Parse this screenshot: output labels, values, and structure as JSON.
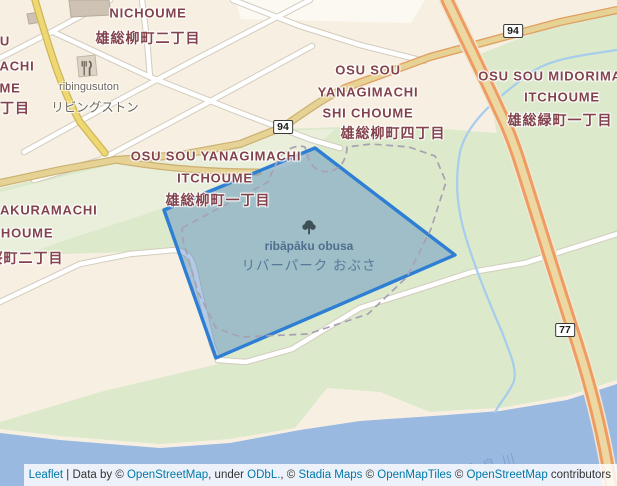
{
  "map": {
    "type": "leaflet-map",
    "colors": {
      "land": "#f7f0e2",
      "green": "#dce9ca",
      "green_pale": "#e9efdb",
      "river": "#9ab9e1",
      "stream": "#a6cdec",
      "road_white": "#ffffff",
      "road_casing": "#d2ccbd",
      "road_yellow": "#eed873",
      "road_tan": "#e7d295",
      "highway_orange": "#ef9c62",
      "highway_center": "#ecd8a2",
      "park_overlay_fill": "rgba(84,138,198,0.45)",
      "park_overlay_border": "#2e7fd4",
      "label_place": "#83434c",
      "label_poi": "#6c675e",
      "label_park": "#4e6e8e",
      "park_boundary_dash": "#a8a1b3",
      "building": "#cdc2b4"
    },
    "labels": [
      {
        "name": "label-nichoume-en",
        "text": "NICHOUME",
        "x": 148,
        "y": 13,
        "cls": "place"
      },
      {
        "name": "label-nichoume-ja",
        "text": "雄総柳町二丁目",
        "x": 148,
        "y": 38,
        "cls": "place-ja"
      },
      {
        "name": "label-edge-fragment-1",
        "text": "U",
        "x": 5,
        "y": 41,
        "cls": "place"
      },
      {
        "name": "label-edge-fragment-2",
        "text": "ACHI",
        "x": 17,
        "y": 66,
        "cls": "place"
      },
      {
        "name": "label-edge-fragment-3",
        "text": "ME",
        "x": 10,
        "y": 88,
        "cls": "place"
      },
      {
        "name": "label-edge-fragment-4",
        "text": "丁目",
        "x": 15,
        "y": 108,
        "cls": "place-ja"
      },
      {
        "name": "label-ribingusuton-en",
        "text": "ribingusuton",
        "x": 89,
        "y": 87,
        "cls": "poi"
      },
      {
        "name": "label-ribingusuton-ja",
        "text": "リビングストン",
        "x": 95,
        "y": 106,
        "cls": "poi-ja"
      },
      {
        "name": "label-yanagimachi4-line1",
        "text": "OSU SOU",
        "x": 368,
        "y": 70,
        "cls": "place"
      },
      {
        "name": "label-yanagimachi4-line2",
        "text": "YANAGIMACHI",
        "x": 368,
        "y": 92,
        "cls": "place"
      },
      {
        "name": "label-yanagimachi4-line3",
        "text": "SHI CHOUME",
        "x": 368,
        "y": 113,
        "cls": "place"
      },
      {
        "name": "label-yanagimachi4-ja",
        "text": "雄総柳町四丁目",
        "x": 393,
        "y": 133,
        "cls": "place-ja"
      },
      {
        "name": "label-midorimachi-line1",
        "text": "OSU SOU MIDORIMA",
        "x": 550,
        "y": 76,
        "cls": "place"
      },
      {
        "name": "label-midorimachi-line2",
        "text": "ITCHOUME",
        "x": 562,
        "y": 97,
        "cls": "place"
      },
      {
        "name": "label-midorimachi-ja",
        "text": "雄総緑町一丁目",
        "x": 560,
        "y": 120,
        "cls": "place-ja"
      },
      {
        "name": "label-yanagimachi1-line1",
        "text": "OSU SOU YANAGIMACHI",
        "x": 216,
        "y": 156,
        "cls": "place"
      },
      {
        "name": "label-yanagimachi1-line2",
        "text": "ITCHOUME",
        "x": 215,
        "y": 178,
        "cls": "place"
      },
      {
        "name": "label-yanagimachi1-ja",
        "text": "雄総柳町一丁目",
        "x": 218,
        "y": 200,
        "cls": "place-ja"
      },
      {
        "name": "label-sakuramachi-en",
        "text": "SAKURAMACHI",
        "x": 44,
        "y": 210,
        "cls": "place"
      },
      {
        "name": "label-sakuramachi-line2",
        "text": "CHOUME",
        "x": 22,
        "y": 233,
        "cls": "place"
      },
      {
        "name": "label-sakuramachi-ja",
        "text": "桜町二丁目",
        "x": 26,
        "y": 258,
        "cls": "place-ja"
      },
      {
        "name": "label-park-name-en",
        "text": "ribāpāku obusa",
        "x": 309,
        "y": 246,
        "cls": "park"
      },
      {
        "name": "label-park-name-ja",
        "text": "リバーパーク おぶさ",
        "x": 309,
        "y": 264,
        "cls": "park-ja"
      },
      {
        "name": "label-river-name",
        "text": "長良川",
        "x": 492,
        "y": 463,
        "cls": "river",
        "rot": -14
      }
    ],
    "shields": [
      {
        "name": "route-shield-94-west",
        "label": "94",
        "x": 283,
        "y": 127
      },
      {
        "name": "route-shield-94-east",
        "label": "94",
        "x": 513,
        "y": 31
      },
      {
        "name": "route-shield-77",
        "label": "77",
        "x": 565,
        "y": 330
      }
    ],
    "attribution": {
      "parts": [
        {
          "text": "Leaflet",
          "link": true,
          "name": "leaflet-link"
        },
        {
          "text": " | Data by © ",
          "link": false
        },
        {
          "text": "OpenStreetMap",
          "link": true,
          "name": "openstreetmap-link"
        },
        {
          "text": ", under ",
          "link": false
        },
        {
          "text": "ODbL.",
          "link": true,
          "name": "odbl-link"
        },
        {
          "text": ", © ",
          "link": false
        },
        {
          "text": "Stadia Maps",
          "link": true,
          "name": "stadia-maps-link"
        },
        {
          "text": " © ",
          "link": false
        },
        {
          "text": "OpenMapTiles",
          "link": true,
          "name": "openmaptiles-link"
        },
        {
          "text": " © ",
          "link": false
        },
        {
          "text": "OpenStreetMap",
          "link": true,
          "name": "openstreetmap-link-2"
        },
        {
          "text": " contributors",
          "link": false
        }
      ]
    }
  }
}
